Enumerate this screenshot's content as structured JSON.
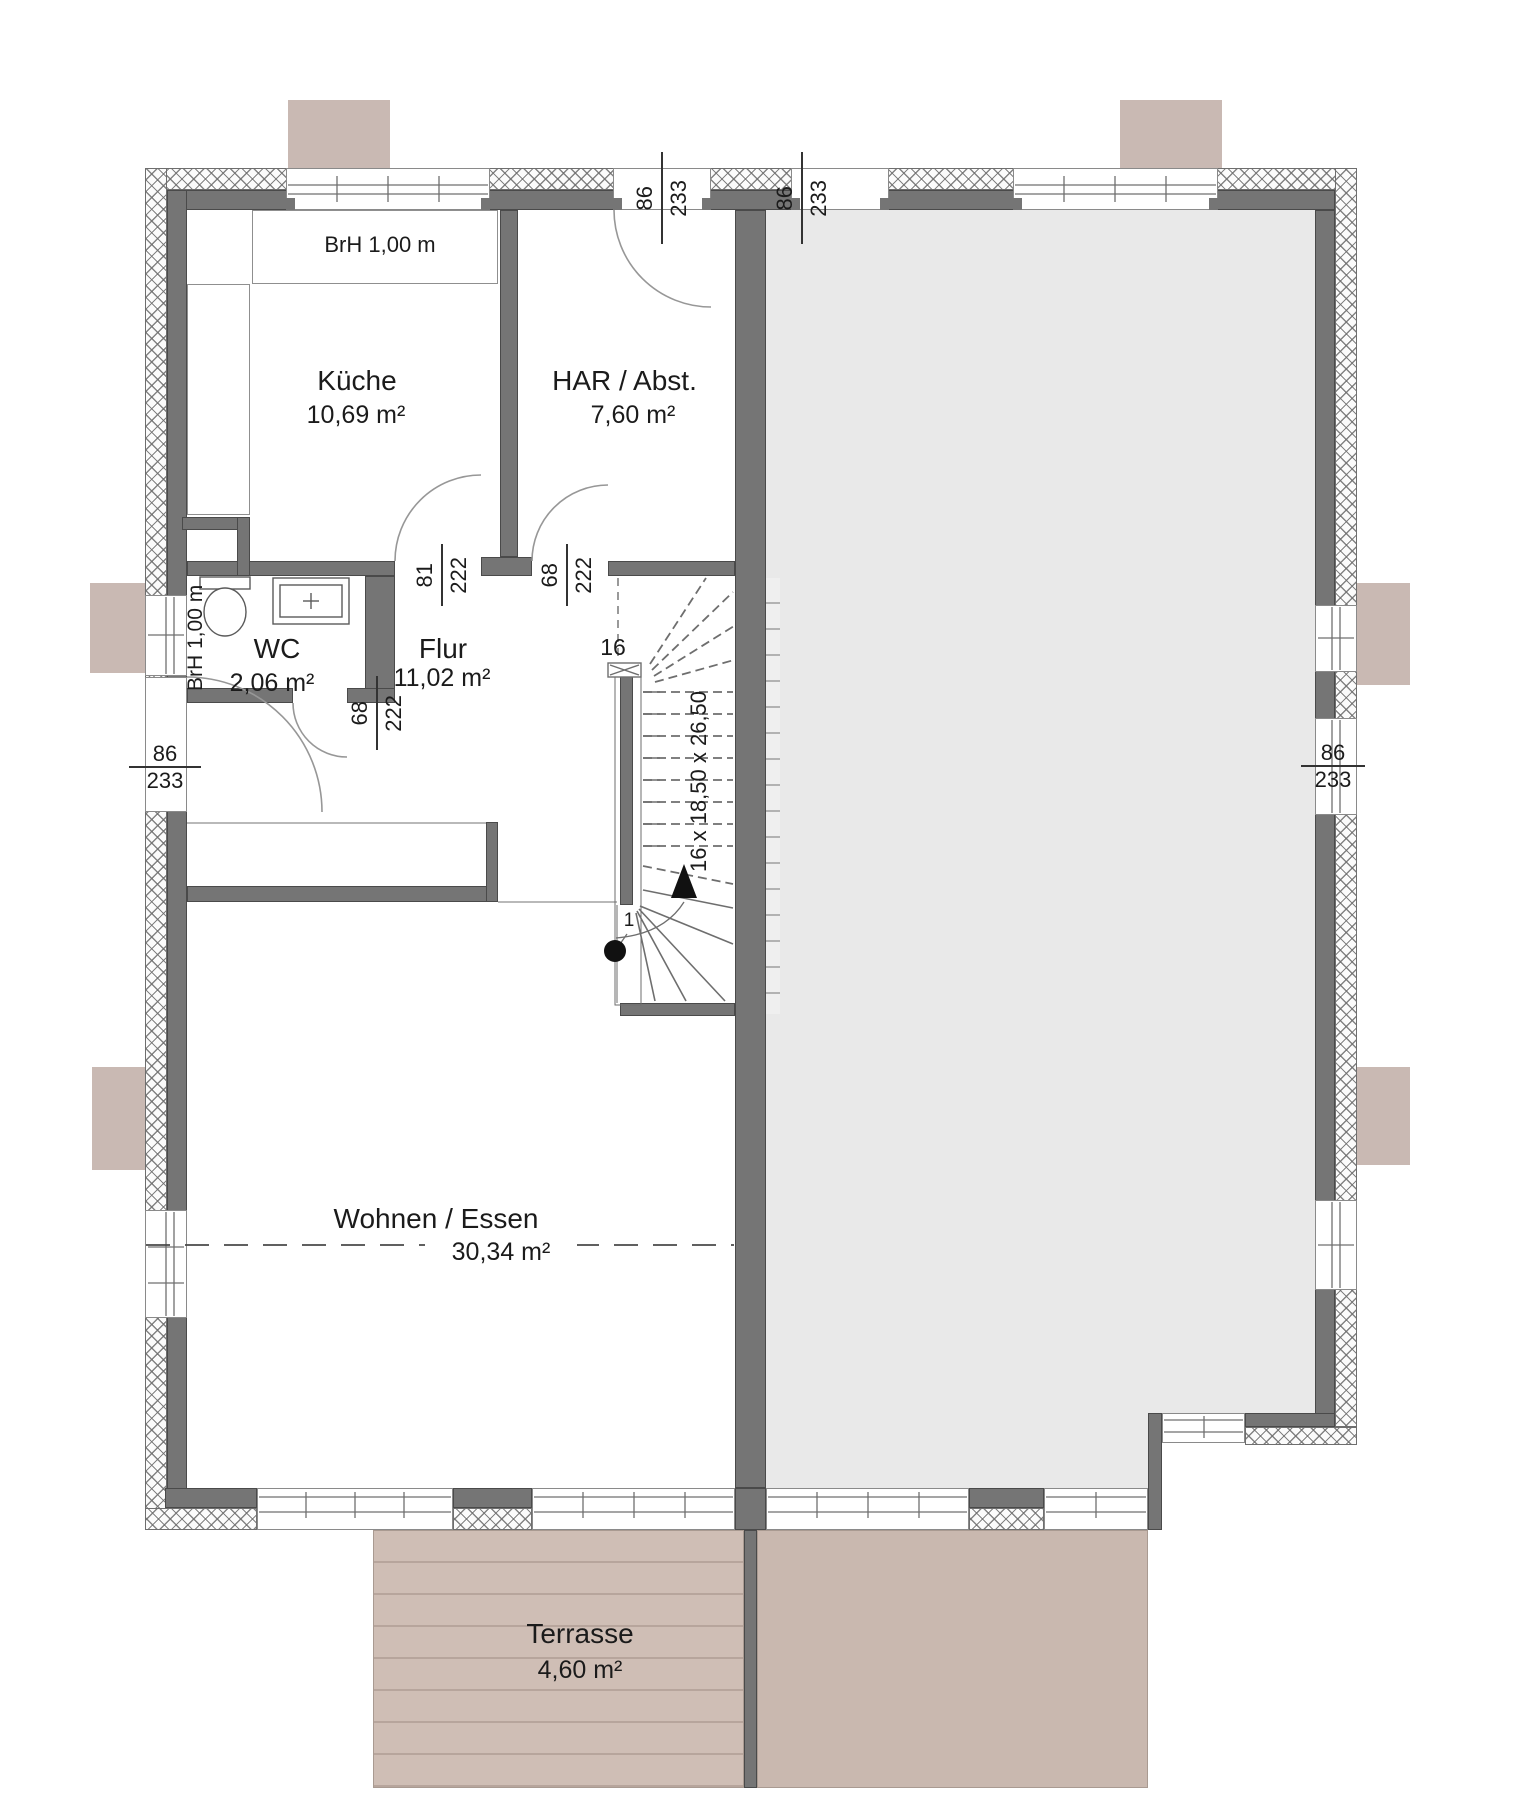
{
  "rooms": {
    "kueche": {
      "name": "Küche",
      "area": "10,69 m²"
    },
    "har": {
      "name": "HAR / Abst.",
      "area": "7,60 m²"
    },
    "wc": {
      "name": "WC",
      "area": "2,06 m²"
    },
    "flur": {
      "name": "Flur",
      "area": "11,02 m²"
    },
    "wohnen": {
      "name": "Wohnen / Essen",
      "area": "30,34 m²"
    },
    "terrasse": {
      "name": "Terrasse",
      "area": "4,60 m²"
    }
  },
  "annotations": {
    "brh_top": "BrH 1,00 m",
    "brh_left": "BrH 1,00 m"
  },
  "stairs": {
    "formula": "16 x 18,50 x 26,50",
    "top_step": "16",
    "first_step": "1"
  },
  "dims": {
    "top_door_left": {
      "w": "86",
      "h": "233"
    },
    "top_door_right": {
      "w": "86",
      "h": "233"
    },
    "entry_door": {
      "w": "86",
      "h": "233"
    },
    "right_window": {
      "w": "86",
      "h": "233"
    },
    "kueche_door": {
      "w": "81",
      "h": "222"
    },
    "har_door": {
      "w": "68",
      "h": "222"
    },
    "wc_door": {
      "w": "68",
      "h": "222"
    }
  },
  "colors": {
    "wall": "#757575",
    "neighbor_fill": "#e9e9e9",
    "terrace_deck": "#cfbeb5",
    "attachment_block": "#c9b9b3",
    "text": "#1b1b1b"
  }
}
